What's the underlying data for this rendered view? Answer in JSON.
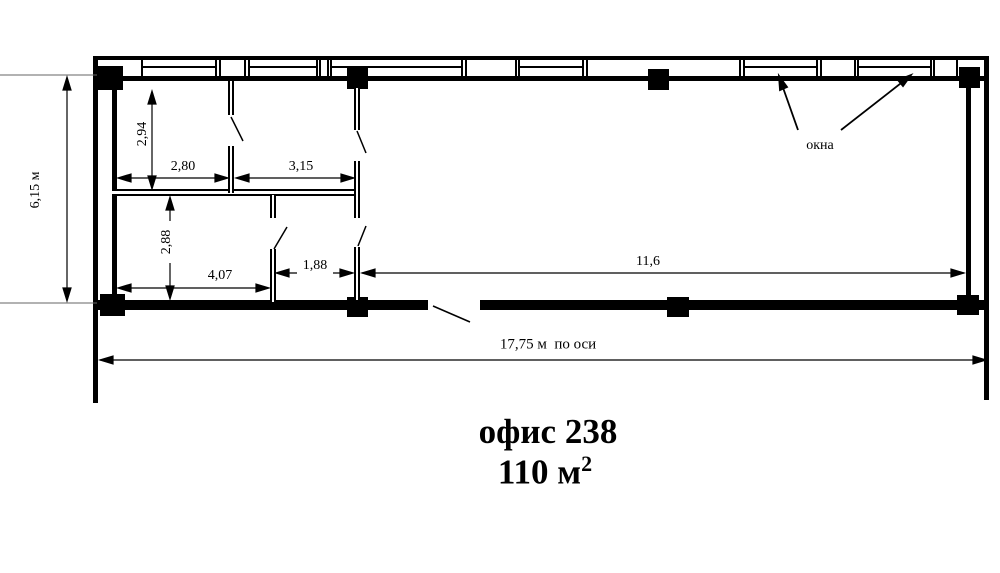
{
  "plan": {
    "windows_label": "окна",
    "dims": {
      "total_height": "6,15 м",
      "upper_room_depth": "2,94",
      "room1_width": "2,80",
      "room2_width": "3,15",
      "lower_room_depth": "2,88",
      "room3_width": "4,07",
      "passage_width": "1,88",
      "open_area_width": "11,6",
      "total_length_axis": "17,75 м  по оси"
    }
  },
  "title": {
    "line1": "офис 238",
    "area_value": "110 м",
    "area_exponent": "2"
  },
  "colors": {
    "line": "#000000",
    "extension_line": "#666666",
    "background": "#ffffff"
  }
}
